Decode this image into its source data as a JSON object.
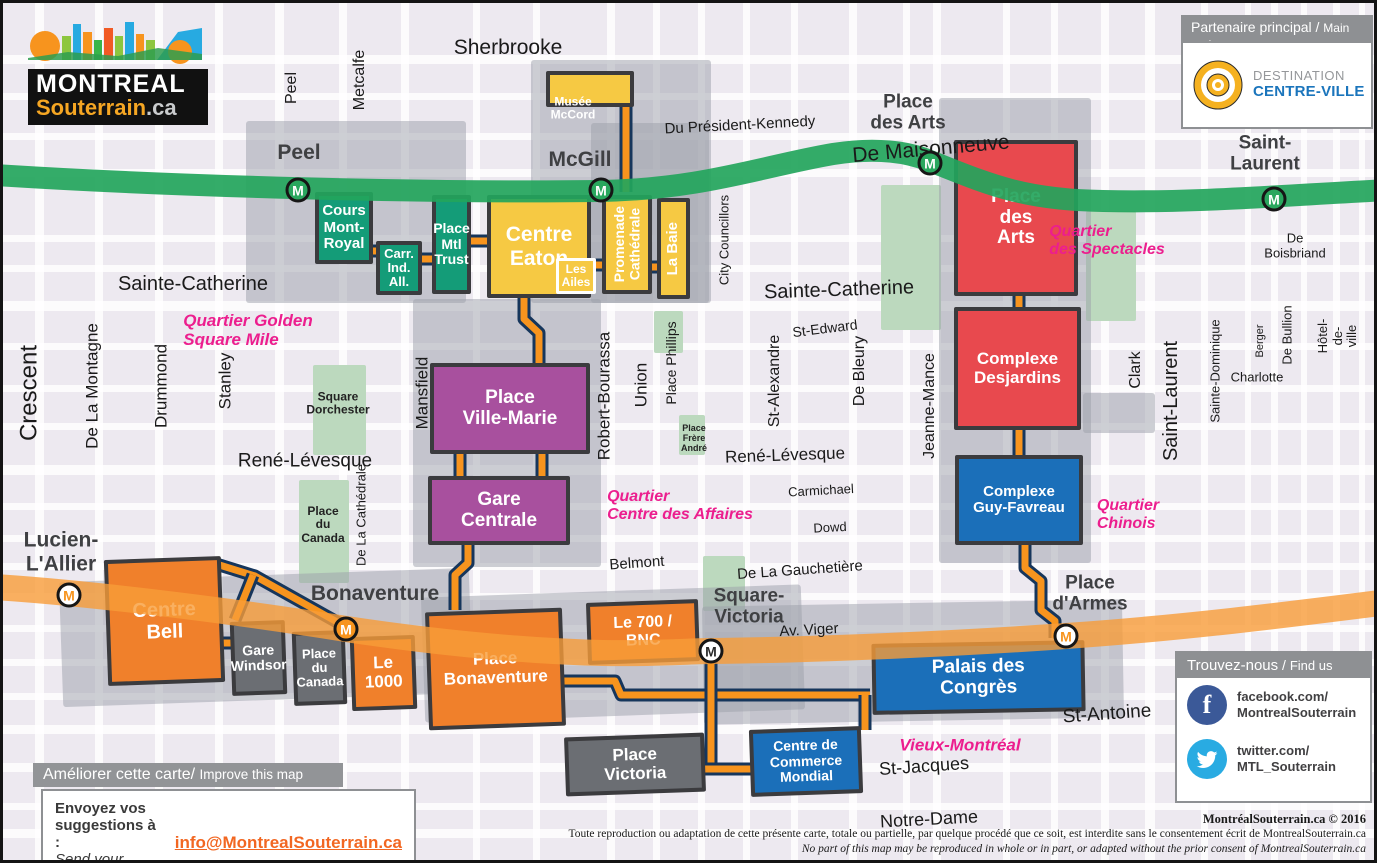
{
  "logo": {
    "line1": "MONTREAL",
    "line2": "Souterrain",
    "line3": ".ca"
  },
  "partner": {
    "header_fr": "Partenaire principal",
    "sep": "/",
    "header_en": "Main partner",
    "brand1": "DESTINATION",
    "brand2": "CENTRE-VILLE"
  },
  "improve": {
    "header_fr": "Améliorer cette carte/",
    "header_en": "Improve this map",
    "line_fr": "Envoyez vos suggestions à :",
    "line_en": "Send your comments at:",
    "email": "info@MontrealSouterrain.ca"
  },
  "findus": {
    "header_fr": "Trouvez-nous",
    "sep": "/",
    "header_en": "Find us",
    "facebook": "facebook.com/\nMontrealSouterrain",
    "twitter": "twitter.com/\nMTL_Souterrain",
    "facebook_color": "#3B5998",
    "twitter_color": "#29ABE2"
  },
  "copyright": {
    "sig": "MontréalSouterrain.ca © 2016",
    "fr": "Toute reproduction ou adaptation de cette présente carte, totale ou partielle, par quelque procédé que ce soit, est interdite sans le consentement écrit de MontrealSouterrain.ca",
    "en": "No part of this map may be reproduced in whole or in part, or adapted without the prior consent of MontrealSouterrain.ca"
  },
  "map": {
    "colors": {
      "orange": "#F0802B",
      "yellow": "#F6C943",
      "green": "#149C78",
      "purple": "#A8509E",
      "red": "#E8494E",
      "blue": "#1B6FB9",
      "gray": "#6B6E73"
    },
    "label_colors": {
      "street": "#1a1a1a",
      "station": "#3F4043",
      "pink": "#EC1E8E",
      "white": "#FFFFFF",
      "dark": "#222222"
    },
    "metro": {
      "marker_letter": "M",
      "green": {
        "color": "#23A55C",
        "width": 22,
        "d": "M-8,172 C180,184 420,190 598,188 C700,186 760,163 830,151 C868,145 900,147 927,158 C985,181 1020,197 1100,198 C1190,200 1270,193 1385,187"
      },
      "orange": {
        "color": "#F89C38",
        "width": 26,
        "d": "M-8,584 C100,591 250,611 343,626 C430,639 520,648 600,650 C650,651 690,648 708,648 C810,647 950,641 1063,633 C1180,625 1290,611 1385,599"
      }
    },
    "tunnel_style": {
      "outline": "#16365C",
      "fill": "#F7941E",
      "outline_w": 13,
      "fill_w": 7
    },
    "tunnels": [
      "M623,95 V189",
      "M361,248 H378",
      "M412,256 H432",
      "M465,238 H488",
      "M521,295 L521,316 L536,330 L536,362",
      "M590,262 H602",
      "M646,264 H658",
      "M457,449 V475",
      "M539,449 V475",
      "M465,540 L465,560 L452,572 L452,607",
      "M210,560 L252,573 L343,624",
      "M250,572 L232,617",
      "M218,640 H230",
      "M558,678 L612,678 L618,692 L867,692",
      "M708,650 V768",
      "M700,766 H749",
      "M862,692 V727",
      "M1016,292 V306",
      "M1016,426 V454",
      "M1022,541 L1022,565 L1038,578 L1038,607 L1052,618 L1052,635"
    ],
    "streets": {
      "h": [
        [
          52,
          9
        ],
        [
          90,
          7
        ],
        [
          130,
          7
        ],
        [
          166,
          8
        ],
        [
          232,
          7
        ],
        [
          262,
          7
        ],
        [
          298,
          10
        ],
        [
          340,
          7
        ],
        [
          382,
          7
        ],
        [
          420,
          7
        ],
        [
          462,
          10
        ],
        [
          500,
          7
        ],
        [
          532,
          7
        ],
        [
          560,
          7
        ],
        [
          590,
          7
        ],
        [
          622,
          7
        ],
        [
          656,
          7
        ],
        [
          690,
          7
        ],
        [
          722,
          9
        ],
        [
          760,
          9
        ],
        [
          800,
          7
        ],
        [
          826,
          9
        ]
      ],
      "v": [
        [
          32,
          9
        ],
        [
          92,
          8
        ],
        [
          152,
          8
        ],
        [
          212,
          8
        ],
        [
          272,
          9
        ],
        [
          336,
          8
        ],
        [
          398,
          8
        ],
        [
          470,
          7
        ],
        [
          530,
          7
        ],
        [
          604,
          8
        ],
        [
          650,
          7
        ],
        [
          695,
          7
        ],
        [
          740,
          7
        ],
        [
          788,
          7
        ],
        [
          846,
          8
        ],
        [
          900,
          7
        ],
        [
          930,
          8
        ],
        [
          1000,
          7
        ],
        [
          1048,
          7
        ],
        [
          1098,
          8
        ],
        [
          1142,
          10
        ],
        [
          1198,
          7
        ],
        [
          1242,
          6
        ],
        [
          1268,
          7
        ],
        [
          1298,
          6
        ],
        [
          1330,
          7
        ],
        [
          1356,
          6
        ]
      ]
    },
    "zones": [
      {
        "n": "uz-peel",
        "x": 243,
        "y": 118,
        "w": 220,
        "h": 182,
        "rot": 0
      },
      {
        "n": "uz-mccord",
        "x": 528,
        "y": 57,
        "w": 180,
        "h": 243,
        "rot": 0
      },
      {
        "n": "uz-mcgill-east",
        "x": 588,
        "y": 120,
        "w": 118,
        "h": 180,
        "rot": 0
      },
      {
        "n": "uz-ville-marie",
        "x": 410,
        "y": 296,
        "w": 188,
        "h": 268,
        "rot": 0
      },
      {
        "n": "uz-place-des-arts",
        "x": 936,
        "y": 95,
        "w": 152,
        "h": 465,
        "rot": 0
      },
      {
        "n": "uz-clark-link",
        "x": 1080,
        "y": 390,
        "w": 72,
        "h": 40,
        "rot": 0
      },
      {
        "n": "uz-bell",
        "x": 58,
        "y": 572,
        "w": 410,
        "h": 125,
        "rot": -2
      },
      {
        "n": "uz-bonaventure",
        "x": 420,
        "y": 588,
        "w": 380,
        "h": 125,
        "rot": -2
      },
      {
        "n": "uz-palais",
        "x": 700,
        "y": 600,
        "w": 420,
        "h": 118,
        "rot": -1
      }
    ],
    "parks": [
      {
        "n": "square-dorchester",
        "x": 310,
        "y": 362,
        "w": 53,
        "h": 90
      },
      {
        "n": "place-du-canada",
        "x": 296,
        "y": 477,
        "w": 50,
        "h": 103
      },
      {
        "n": "place-phillips",
        "x": 651,
        "y": 308,
        "w": 29,
        "h": 42
      },
      {
        "n": "place-frere-andre",
        "x": 676,
        "y": 412,
        "w": 26,
        "h": 40
      },
      {
        "n": "pda-west",
        "x": 878,
        "y": 182,
        "w": 60,
        "h": 145
      },
      {
        "n": "pda-east",
        "x": 1083,
        "y": 208,
        "w": 50,
        "h": 110
      },
      {
        "n": "bonaventure-green",
        "x": 700,
        "y": 553,
        "w": 42,
        "h": 55
      }
    ],
    "buildings": [
      {
        "n": "musee-mccord",
        "t": "",
        "x": 543,
        "y": 68,
        "w": 88,
        "h": 36,
        "c": "yellow",
        "fs": 12
      },
      {
        "n": "cours-mont-royal",
        "t": "Cours\nMont-\nRoyal",
        "x": 312,
        "y": 189,
        "w": 58,
        "h": 72,
        "c": "green",
        "fs": 15
      },
      {
        "n": "carrefour-industriel-alliance",
        "t": "Carr.\nInd.\nAll.",
        "x": 373,
        "y": 238,
        "w": 46,
        "h": 54,
        "c": "green",
        "fs": 13
      },
      {
        "n": "place-montreal-trust",
        "t": "Place\nMtl\nTrust",
        "x": 429,
        "y": 192,
        "w": 39,
        "h": 99,
        "c": "green",
        "fs": 14
      },
      {
        "n": "centre-eaton",
        "t": "Centre\nEaton",
        "x": 484,
        "y": 192,
        "w": 104,
        "h": 103,
        "c": "yellow",
        "fs": 21
      },
      {
        "n": "les-ailes",
        "t": "Les\nAiles",
        "x": 553,
        "y": 255,
        "w": 40,
        "h": 36,
        "c": "yellow",
        "fs": 12,
        "border": "#fff"
      },
      {
        "n": "promenade-cathedrale",
        "t": "Promenade\nCathédrale",
        "x": 599,
        "y": 192,
        "w": 50,
        "h": 99,
        "c": "yellow",
        "fs": 14,
        "v": true
      },
      {
        "n": "la-baie",
        "t": "La Baie",
        "x": 654,
        "y": 195,
        "w": 33,
        "h": 101,
        "c": "yellow",
        "fs": 15,
        "v": true
      },
      {
        "n": "place-ville-marie",
        "t": "Place\nVille-Marie",
        "x": 427,
        "y": 360,
        "w": 160,
        "h": 91,
        "c": "purple",
        "fs": 19
      },
      {
        "n": "gare-centrale",
        "t": "Gare\nCentrale",
        "x": 425,
        "y": 473,
        "w": 142,
        "h": 69,
        "c": "purple",
        "fs": 19
      },
      {
        "n": "centre-bell",
        "t": "Centre\nBell",
        "x": 103,
        "y": 555,
        "w": 117,
        "h": 126,
        "c": "orange",
        "fs": 20,
        "rot": -2
      },
      {
        "n": "gare-windsor",
        "t": "Gare\nWindsor",
        "x": 228,
        "y": 618,
        "w": 55,
        "h": 74,
        "c": "gray",
        "fs": 14,
        "rot": -2
      },
      {
        "n": "place-du-canada-building",
        "t": "Place\ndu\nCanada",
        "x": 290,
        "y": 628,
        "w": 53,
        "h": 74,
        "c": "gray",
        "fs": 13,
        "rot": -2
      },
      {
        "n": "le-1000",
        "t": "Le\n1000",
        "x": 348,
        "y": 633,
        "w": 65,
        "h": 74,
        "c": "orange",
        "fs": 17,
        "rot": -2
      },
      {
        "n": "place-bonaventure",
        "t": "Place\nBonaventure",
        "x": 424,
        "y": 607,
        "w": 137,
        "h": 118,
        "c": "orange",
        "fs": 17,
        "rot": -2
      },
      {
        "n": "le-700-bnc",
        "t": "Le 700 /\nBNC",
        "x": 584,
        "y": 598,
        "w": 112,
        "h": 62,
        "c": "orange",
        "fs": 16,
        "rot": -2
      },
      {
        "n": "place-victoria",
        "t": "Place\nVictoria",
        "x": 562,
        "y": 732,
        "w": 140,
        "h": 59,
        "c": "gray",
        "fs": 17,
        "rot": -2
      },
      {
        "n": "centre-de-commerce-mondial",
        "t": "Centre de\nCommerce\nMondial",
        "x": 747,
        "y": 725,
        "w": 112,
        "h": 67,
        "c": "blue",
        "fs": 14,
        "rot": -2
      },
      {
        "n": "palais-des-congres",
        "t": "Palais des\nCongrès",
        "x": 869,
        "y": 639,
        "w": 213,
        "h": 71,
        "c": "blue",
        "fs": 19,
        "rot": -1
      },
      {
        "n": "place-des-arts-building",
        "t": "Place\ndes\nArts",
        "x": 951,
        "y": 137,
        "w": 124,
        "h": 156,
        "c": "red",
        "fs": 19
      },
      {
        "n": "complexe-desjardins",
        "t": "Complexe\nDesjardins",
        "x": 951,
        "y": 304,
        "w": 127,
        "h": 123,
        "c": "red",
        "fs": 17
      },
      {
        "n": "complexe-guy-favreau",
        "t": "Complexe\nGuy-Favreau",
        "x": 952,
        "y": 452,
        "w": 128,
        "h": 90,
        "c": "blue",
        "fs": 15
      }
    ],
    "street_labels": [
      {
        "t": "Sherbrooke",
        "x": 505,
        "y": 45,
        "fs": 21
      },
      {
        "t": "Peel",
        "x": 289,
        "y": 85,
        "fs": 16,
        "rot": -90
      },
      {
        "t": "Metcalfe",
        "x": 357,
        "y": 77,
        "fs": 16,
        "rot": -90
      },
      {
        "t": "Du Président-Kennedy",
        "x": 737,
        "y": 123,
        "fs": 15,
        "rot": -3
      },
      {
        "t": "De Maisonneuve",
        "x": 928,
        "y": 146,
        "fs": 21,
        "rot": -5
      },
      {
        "t": "Sainte-Catherine",
        "x": 190,
        "y": 281,
        "fs": 20
      },
      {
        "t": "Sainte-Catherine",
        "x": 836,
        "y": 287,
        "fs": 20,
        "rot": -2
      },
      {
        "t": "City Councillors",
        "x": 722,
        "y": 237,
        "fs": 13,
        "rot": -90
      },
      {
        "t": "St-Edward",
        "x": 822,
        "y": 326,
        "fs": 14,
        "rot": -7
      },
      {
        "t": "Crescent",
        "x": 27,
        "y": 390,
        "fs": 24,
        "rot": -90
      },
      {
        "t": "De La Montagne",
        "x": 89,
        "y": 383,
        "fs": 17,
        "rot": -90
      },
      {
        "t": "Drummond",
        "x": 158,
        "y": 383,
        "fs": 17,
        "rot": -90
      },
      {
        "t": "Stanley",
        "x": 222,
        "y": 378,
        "fs": 17,
        "rot": -90
      },
      {
        "t": "Mansfield",
        "x": 419,
        "y": 390,
        "fs": 17,
        "rot": -90
      },
      {
        "t": "De La Cathédrale",
        "x": 359,
        "y": 512,
        "fs": 13,
        "rot": -90
      },
      {
        "t": "Robert-Bourassa",
        "x": 601,
        "y": 393,
        "fs": 17,
        "rot": -90
      },
      {
        "t": "Union",
        "x": 638,
        "y": 382,
        "fs": 17,
        "rot": -90
      },
      {
        "t": "Place Phillips",
        "x": 669,
        "y": 360,
        "fs": 14,
        "rot": -90
      },
      {
        "t": "St-Alexandre",
        "x": 772,
        "y": 378,
        "fs": 16,
        "rot": -90
      },
      {
        "t": "De Bleury",
        "x": 857,
        "y": 368,
        "fs": 16,
        "rot": -90
      },
      {
        "t": "Jeanne-Mance",
        "x": 927,
        "y": 403,
        "fs": 16,
        "rot": -90
      },
      {
        "t": "Clark",
        "x": 1133,
        "y": 367,
        "fs": 16,
        "rot": -90
      },
      {
        "t": "Saint-Laurent",
        "x": 1168,
        "y": 398,
        "fs": 20,
        "rot": -90
      },
      {
        "t": "Sainte-Dominique",
        "x": 1213,
        "y": 368,
        "fs": 13,
        "rot": -90
      },
      {
        "t": "Berger",
        "x": 1257,
        "y": 338,
        "fs": 11,
        "rot": -90
      },
      {
        "t": "De Bullion",
        "x": 1285,
        "y": 332,
        "fs": 13,
        "rot": -90
      },
      {
        "t": "Hôtel-de-ville",
        "x": 1335,
        "y": 333,
        "fs": 13,
        "rot": -90
      },
      {
        "t": "Charlotte",
        "x": 1254,
        "y": 375,
        "fs": 13
      },
      {
        "t": "De Boisbriand",
        "x": 1292,
        "y": 243,
        "fs": 13
      },
      {
        "t": "René-Lévesque",
        "x": 302,
        "y": 458,
        "fs": 19
      },
      {
        "t": "René-Lévesque",
        "x": 782,
        "y": 452,
        "fs": 17,
        "rot": -2
      },
      {
        "t": "Carmichael",
        "x": 818,
        "y": 488,
        "fs": 13,
        "rot": -3
      },
      {
        "t": "Dowd",
        "x": 827,
        "y": 525,
        "fs": 13,
        "rot": -3
      },
      {
        "t": "Belmont",
        "x": 634,
        "y": 561,
        "fs": 15,
        "rot": -4
      },
      {
        "t": "De La Gauchetière",
        "x": 797,
        "y": 568,
        "fs": 15,
        "rot": -4
      },
      {
        "t": "Av. Viger",
        "x": 806,
        "y": 628,
        "fs": 15,
        "rot": -3
      },
      {
        "t": "St-Antoine",
        "x": 1104,
        "y": 711,
        "fs": 19,
        "rot": -4
      },
      {
        "t": "St-Jacques",
        "x": 921,
        "y": 763,
        "fs": 18,
        "rot": -4
      },
      {
        "t": "Notre-Dame",
        "x": 926,
        "y": 816,
        "fs": 18,
        "rot": -3
      }
    ],
    "area_labels": [
      {
        "t": "Musée\nMcCord",
        "x": 570,
        "y": 106,
        "fs": 12,
        "c": "white"
      },
      {
        "t": "Square\nDorchester",
        "x": 335,
        "y": 401,
        "fs": 12,
        "c": "dark"
      },
      {
        "t": "Place\ndu\nCanada",
        "x": 320,
        "y": 522,
        "fs": 12,
        "c": "dark"
      },
      {
        "t": "Place\nFrère\nAndré",
        "x": 691,
        "y": 435,
        "fs": 9,
        "c": "dark"
      }
    ],
    "district_labels": [
      {
        "t": "Quartier Golden\nSquare Mile",
        "x": 245,
        "y": 327,
        "fs": 17
      },
      {
        "t": "Quartier\ndes Spectacles",
        "x": 1104,
        "y": 238,
        "fs": 16
      },
      {
        "t": "Quartier\nCentre des Affaires",
        "x": 677,
        "y": 503,
        "fs": 16
      },
      {
        "t": "Quartier\nChinois",
        "x": 1125,
        "y": 512,
        "fs": 16
      },
      {
        "t": "Vieux-Montréal",
        "x": 957,
        "y": 742,
        "fs": 17
      }
    ],
    "stations": [
      {
        "n": "peel",
        "t": "Peel",
        "lx": 296,
        "ly": 150,
        "fs": 21,
        "mx": 295,
        "my": 187,
        "fill": "#2AA75E",
        "letter": "#fff"
      },
      {
        "n": "mcgill",
        "t": "McGill",
        "lx": 577,
        "ly": 157,
        "fs": 21,
        "mx": 598,
        "my": 187,
        "fill": "#2AA75E",
        "letter": "#fff"
      },
      {
        "n": "place-des-arts",
        "t": "Place\ndes Arts",
        "lx": 905,
        "ly": 110,
        "fs": 19,
        "mx": 927,
        "my": 160,
        "fill": "#2AA75E",
        "letter": "#fff"
      },
      {
        "n": "saint-laurent",
        "t": "Saint-\nLaurent",
        "lx": 1262,
        "ly": 151,
        "fs": 19,
        "mx": 1271,
        "my": 196,
        "fill": "#2AA75E",
        "letter": "#fff"
      },
      {
        "n": "lucien-l-allier",
        "t": "Lucien-\nL'Allier",
        "lx": 58,
        "ly": 549,
        "fs": 21,
        "mx": 66,
        "my": 592,
        "fill": "#fff",
        "letter": "#F7941E"
      },
      {
        "n": "bonaventure",
        "t": "Bonaventure",
        "lx": 372,
        "ly": 591,
        "fs": 21,
        "mx": 343,
        "my": 626,
        "fill": "#F7941E",
        "letter": "#fff"
      },
      {
        "n": "square-victoria",
        "t": "Square-\nVictoria",
        "lx": 746,
        "ly": 604,
        "fs": 19,
        "mx": 708,
        "my": 648,
        "fill": "#fff",
        "letter": "#2b2b2b"
      },
      {
        "n": "place-d-armes",
        "t": "Place\nd'Armes",
        "lx": 1087,
        "ly": 591,
        "fs": 19,
        "mx": 1063,
        "my": 633,
        "fill": "#fff",
        "letter": "#F7941E"
      }
    ]
  }
}
